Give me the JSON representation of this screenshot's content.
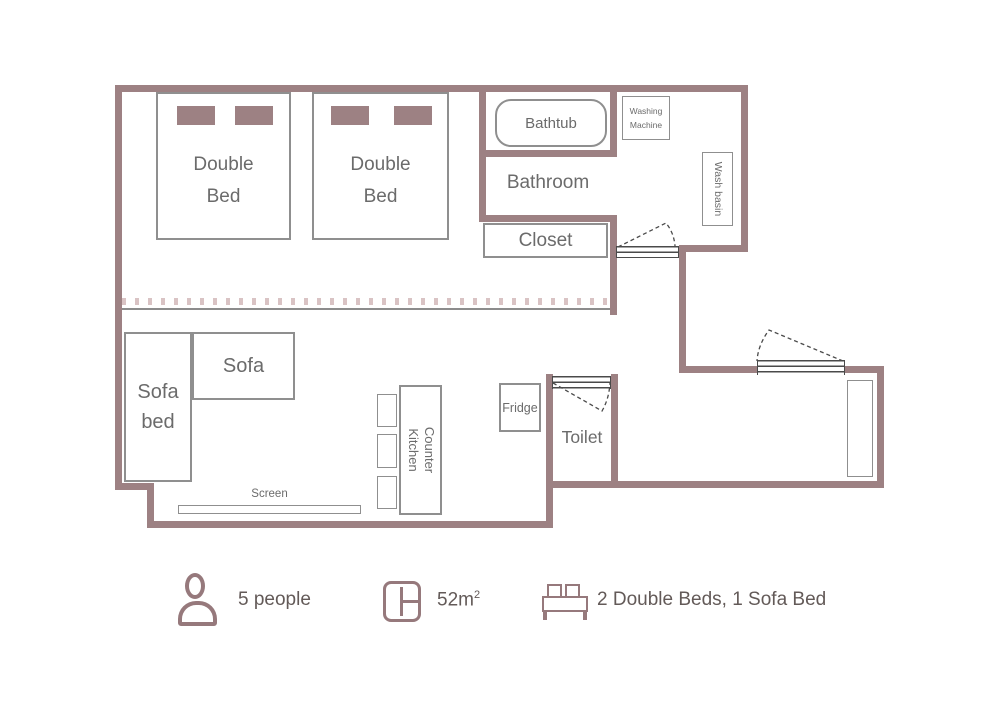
{
  "plan": {
    "rooms": {
      "bathroom": "Bathroom",
      "toilet": "Toilet",
      "closet": "Closet"
    },
    "furniture": {
      "double_bed_1": {
        "line1": "Double",
        "line2": "Bed"
      },
      "double_bed_2": {
        "line1": "Double",
        "line2": "Bed"
      },
      "bathtub": "Bathtub",
      "washing_machine": {
        "line1": "Washing",
        "line2": "Machine"
      },
      "wash_basin": "Wash basin",
      "sofa": "Sofa",
      "sofa_bed": {
        "line1": "Sofa",
        "line2": "bed"
      },
      "counter_kitchen": {
        "line1": "Counter",
        "line2": "Kitchen"
      },
      "fridge": "Fridge",
      "screen": "Screen"
    },
    "colors": {
      "wall": "#9d8183",
      "furniture_border": "#8f8f8f",
      "label_text": "#6b6b6b",
      "door_line": "#4a4a4a",
      "partition_track": "#8c8c8c",
      "legend_icon": "#96797c",
      "legend_text": "#635a58"
    }
  },
  "legend": {
    "capacity": "5 people",
    "area_value": "52m",
    "area_sup": "2",
    "beds": "2 Double Beds, 1 Sofa Bed"
  }
}
